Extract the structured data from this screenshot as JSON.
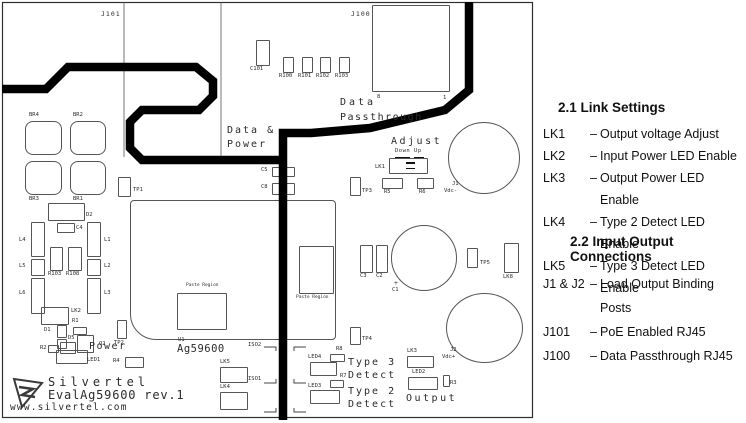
{
  "board": {
    "logo": {
      "brand": "Silvertel",
      "model": "EvalAg59600 rev.1",
      "url": "www.silvertel.com"
    },
    "components": [
      {
        "ref": "J100",
        "x": 372,
        "y": 5,
        "w": 78,
        "h": 87
      },
      {
        "ref": "C101",
        "label": "C101",
        "x": 256,
        "y": 40,
        "w": 14,
        "h": 26,
        "lx": 250,
        "ly": 67
      },
      {
        "ref": "R100",
        "label": "R100",
        "x": 283,
        "y": 57,
        "w": 11,
        "h": 16,
        "lx": 279,
        "ly": 74
      },
      {
        "ref": "R101",
        "label": "R101",
        "x": 302,
        "y": 57,
        "w": 11,
        "h": 16,
        "lx": 298,
        "ly": 74
      },
      {
        "ref": "R102",
        "label": "R102",
        "x": 320,
        "y": 57,
        "w": 11,
        "h": 16,
        "lx": 316,
        "ly": 74
      },
      {
        "ref": "R103A",
        "label": "R103",
        "x": 339,
        "y": 57,
        "w": 11,
        "h": 16,
        "lx": 335,
        "ly": 74
      },
      {
        "ref": "BR4",
        "label": "BR4",
        "x": 25,
        "y": 121,
        "w": 37,
        "h": 34,
        "lx": 29,
        "ly": 113,
        "shape": "br"
      },
      {
        "ref": "BR2",
        "label": "BR2",
        "x": 70,
        "y": 121,
        "w": 36,
        "h": 34,
        "lx": 73,
        "ly": 113,
        "shape": "br"
      },
      {
        "ref": "BR3",
        "label": "BR3",
        "x": 25,
        "y": 161,
        "w": 37,
        "h": 34,
        "lx": 29,
        "ly": 197,
        "shape": "br"
      },
      {
        "ref": "BR1",
        "label": "BR1",
        "x": 70,
        "y": 161,
        "w": 36,
        "h": 34,
        "lx": 73,
        "ly": 197,
        "shape": "br"
      },
      {
        "ref": "TP1",
        "label": "TP1",
        "x": 118,
        "y": 177,
        "w": 13,
        "h": 20,
        "lx": 133,
        "ly": 188
      },
      {
        "ref": "D2",
        "label": "D2",
        "x": 48,
        "y": 203,
        "w": 37,
        "h": 18,
        "lx": 86,
        "ly": 213
      },
      {
        "ref": "C4",
        "label": "C4",
        "x": 57,
        "y": 223,
        "w": 18,
        "h": 10,
        "lx": 76,
        "ly": 226
      },
      {
        "ref": "L4",
        "label": "L4",
        "x": 31,
        "y": 222,
        "w": 14,
        "h": 35,
        "lx": 19,
        "ly": 238
      },
      {
        "ref": "L5",
        "label": "L5",
        "x": 31,
        "y": 259,
        "w": 14,
        "h": 17,
        "lx": 19,
        "ly": 264
      },
      {
        "ref": "L6",
        "label": "L6",
        "x": 31,
        "y": 278,
        "w": 14,
        "h": 36,
        "lx": 19,
        "ly": 291
      },
      {
        "ref": "L1",
        "label": "L1",
        "x": 87,
        "y": 222,
        "w": 14,
        "h": 35,
        "lx": 104,
        "ly": 238
      },
      {
        "ref": "L2",
        "label": "L2",
        "x": 87,
        "y": 259,
        "w": 14,
        "h": 17,
        "lx": 104,
        "ly": 264
      },
      {
        "ref": "L3",
        "label": "L3",
        "x": 87,
        "y": 278,
        "w": 14,
        "h": 36,
        "lx": 104,
        "ly": 291
      },
      {
        "ref": "R103B",
        "label": "R103",
        "x": 50,
        "y": 247,
        "w": 13,
        "h": 24,
        "lx": 48,
        "ly": 272
      },
      {
        "ref": "R108",
        "label": "R108",
        "x": 68,
        "y": 247,
        "w": 14,
        "h": 24,
        "lx": 66,
        "ly": 272
      },
      {
        "ref": "LK2",
        "label": "LK2",
        "x": 41,
        "y": 307,
        "w": 28,
        "h": 18,
        "lx": 71,
        "ly": 309
      },
      {
        "ref": "R1",
        "label": "R1",
        "x": 73,
        "y": 327,
        "w": 14,
        "h": 8,
        "lx": 72,
        "ly": 319
      },
      {
        "ref": "D1",
        "label": "D1",
        "x": 57,
        "y": 325,
        "w": 10,
        "h": 13,
        "lx": 44,
        "ly": 328
      },
      {
        "ref": "D5",
        "label": "D5",
        "x": 57,
        "y": 339,
        "w": 10,
        "h": 10,
        "lx": 68,
        "ly": 336
      },
      {
        "ref": "R2",
        "label": "R2",
        "x": 48,
        "y": 345,
        "w": 11,
        "h": 8,
        "lx": 40,
        "ly": 346
      },
      {
        "ref": "Q1",
        "x": 60,
        "y": 342,
        "w": 16,
        "h": 12
      },
      {
        "ref": "Q2",
        "label": "Q2",
        "x": 77,
        "y": 335,
        "w": 17,
        "h": 18,
        "lx": 99,
        "ly": 342
      },
      {
        "ref": "LED1",
        "label": "LED1",
        "x": 56,
        "y": 350,
        "w": 32,
        "h": 14,
        "lx": 87,
        "ly": 358
      },
      {
        "ref": "R4",
        "label": "R4",
        "x": 125,
        "y": 357,
        "w": 19,
        "h": 11,
        "lx": 113,
        "ly": 359
      },
      {
        "ref": "TP2",
        "label": "TP2",
        "x": 117,
        "y": 320,
        "w": 10,
        "h": 19,
        "lx": 114,
        "ly": 341
      },
      {
        "ref": "U1",
        "x": 130,
        "y": 200,
        "w": 206,
        "h": 140,
        "shape": "ic"
      },
      {
        "ref": "PASTE1",
        "x": 177,
        "y": 293,
        "w": 50,
        "h": 37
      },
      {
        "ref": "PASTE2",
        "x": 299,
        "y": 246,
        "w": 35,
        "h": 48
      },
      {
        "ref": "C5",
        "label": "C5",
        "x": 272,
        "y": 167,
        "w": 23,
        "h": 10,
        "lx": 261,
        "ly": 168
      },
      {
        "ref": "C8",
        "label": "C8",
        "x": 272,
        "y": 183,
        "w": 23,
        "h": 12,
        "lx": 261,
        "ly": 185
      },
      {
        "ref": "TP3",
        "label": "TP3",
        "x": 350,
        "y": 177,
        "w": 11,
        "h": 19,
        "lx": 362,
        "ly": 189
      },
      {
        "ref": "LK1",
        "label": "LK1",
        "x": 389,
        "y": 158,
        "w": 39,
        "h": 16,
        "lx": 375,
        "ly": 165
      },
      {
        "ref": "R5",
        "label": "R5",
        "x": 382,
        "y": 178,
        "w": 21,
        "h": 11,
        "lx": 384,
        "ly": 190
      },
      {
        "ref": "R6",
        "label": "R6",
        "x": 417,
        "y": 178,
        "w": 17,
        "h": 11,
        "lx": 419,
        "ly": 190
      },
      {
        "ref": "J1",
        "x": 448,
        "y": 122,
        "w": 72,
        "h": 72,
        "shape": "circle"
      },
      {
        "ref": "C3",
        "label": "C3",
        "x": 360,
        "y": 245,
        "w": 13,
        "h": 28,
        "lx": 360,
        "ly": 274
      },
      {
        "ref": "C2",
        "label": "C2",
        "x": 376,
        "y": 245,
        "w": 12,
        "h": 28,
        "lx": 376,
        "ly": 274
      },
      {
        "ref": "C1",
        "x": 391,
        "y": 225,
        "w": 66,
        "h": 66,
        "shape": "circle"
      },
      {
        "ref": "TP5",
        "label": "TP5",
        "x": 467,
        "y": 248,
        "w": 11,
        "h": 20,
        "lx": 480,
        "ly": 261
      },
      {
        "ref": "LK8",
        "label": "LK8",
        "x": 504,
        "y": 243,
        "w": 15,
        "h": 30,
        "lx": 503,
        "ly": 275
      },
      {
        "ref": "TP4",
        "label": "TP4",
        "x": 350,
        "y": 327,
        "w": 11,
        "h": 18,
        "lx": 362,
        "ly": 337
      },
      {
        "ref": "R8",
        "label": "R8",
        "x": 330,
        "y": 354,
        "w": 15,
        "h": 8,
        "lx": 336,
        "ly": 347
      },
      {
        "ref": "LED4",
        "label": "LED4",
        "x": 310,
        "y": 362,
        "w": 27,
        "h": 14,
        "lx": 308,
        "ly": 355
      },
      {
        "ref": "R7",
        "label": "R7",
        "x": 330,
        "y": 380,
        "w": 14,
        "h": 8,
        "lx": 340,
        "ly": 374
      },
      {
        "ref": "LED3",
        "label": "LED3",
        "x": 310,
        "y": 390,
        "w": 30,
        "h": 14,
        "lx": 308,
        "ly": 384
      },
      {
        "ref": "LK3",
        "label": "LK3",
        "x": 407,
        "y": 356,
        "w": 27,
        "h": 12,
        "lx": 407,
        "ly": 349
      },
      {
        "ref": "LED2",
        "label": "LED2",
        "x": 408,
        "y": 377,
        "w": 30,
        "h": 13,
        "lx": 412,
        "ly": 370
      },
      {
        "ref": "R3",
        "label": "R3",
        "x": 443,
        "y": 375,
        "w": 7,
        "h": 12,
        "lx": 450,
        "ly": 381
      },
      {
        "ref": "J2",
        "x": 446,
        "y": 293,
        "w": 77,
        "h": 70,
        "shape": "circle"
      },
      {
        "ref": "LK5",
        "label": "LK5",
        "x": 220,
        "y": 367,
        "w": 28,
        "h": 16,
        "lx": 220,
        "ly": 360
      },
      {
        "ref": "LK4",
        "label": "LK4",
        "x": 220,
        "y": 392,
        "w": 28,
        "h": 18,
        "lx": 220,
        "ly": 385
      }
    ],
    "texts": [
      {
        "id": "j101-label",
        "t": "J101",
        "x": 101,
        "y": 11,
        "s": 6.5,
        "ls": 1
      },
      {
        "id": "j100-label",
        "t": "J100",
        "x": 351,
        "y": 11,
        "s": 6.5,
        "ls": 1
      },
      {
        "id": "data-passthrough-line1",
        "t": "Data",
        "x": 340,
        "y": 98,
        "s": 10,
        "ls": 3
      },
      {
        "id": "pin-8",
        "t": "8",
        "x": 377,
        "y": 95,
        "s": 5.5,
        "ls": 0
      },
      {
        "id": "pin-1",
        "t": "1",
        "x": 443,
        "y": 96,
        "s": 5.5,
        "ls": 0
      },
      {
        "id": "data-passthrough-line2",
        "t": "Passthrough",
        "x": 340,
        "y": 113,
        "s": 10,
        "ls": 1.5
      },
      {
        "id": "data-power-line1",
        "t": "Data &",
        "x": 227,
        "y": 126,
        "s": 10,
        "ls": 2
      },
      {
        "id": "data-power-line2",
        "t": "Power",
        "x": 227,
        "y": 140,
        "s": 10,
        "ls": 2
      },
      {
        "id": "adjust-label",
        "t": "Adjust",
        "x": 391,
        "y": 137,
        "s": 10,
        "ls": 2.5
      },
      {
        "id": "down-up-label",
        "t": "Down Up",
        "x": 395,
        "y": 149,
        "s": 5.5,
        "ls": 0.5
      },
      {
        "id": "power-label",
        "t": "Power",
        "x": 89,
        "y": 342,
        "s": 10,
        "ls": 1.5
      },
      {
        "id": "type3-line1",
        "t": "Type 3",
        "x": 348,
        "y": 358,
        "s": 10,
        "ls": 2
      },
      {
        "id": "type3-line2",
        "t": "Detect",
        "x": 348,
        "y": 371,
        "s": 10,
        "ls": 2
      },
      {
        "id": "type2-line1",
        "t": "Type 2",
        "x": 348,
        "y": 387,
        "s": 10,
        "ls": 2
      },
      {
        "id": "type2-line2",
        "t": "Detect",
        "x": 348,
        "y": 400,
        "s": 10,
        "ls": 2
      },
      {
        "id": "output-label",
        "t": "Output",
        "x": 406,
        "y": 394,
        "s": 10,
        "ls": 2.5
      },
      {
        "id": "u1-ref",
        "t": "U1",
        "x": 178,
        "y": 338,
        "s": 5.5,
        "ls": 0
      },
      {
        "id": "u1-part",
        "t": "Ag59600",
        "x": 177,
        "y": 344,
        "s": 10.5,
        "ls": 0.5
      },
      {
        "id": "iso2-label",
        "t": "ISO2",
        "x": 248,
        "y": 343,
        "s": 5.5,
        "ls": 0
      },
      {
        "id": "iso1-label",
        "t": "ISO1",
        "x": 248,
        "y": 377,
        "s": 5.5,
        "ls": 0
      },
      {
        "id": "paste-region-1",
        "t": "Paste Region",
        "x": 186,
        "y": 284,
        "s": 4.5,
        "ls": 0
      },
      {
        "id": "paste-region-2",
        "t": "Paste Region",
        "x": 296,
        "y": 296,
        "s": 4.5,
        "ls": 0
      },
      {
        "id": "j1-ref",
        "t": "J1",
        "x": 452,
        "y": 182,
        "s": 5.5,
        "ls": 0
      },
      {
        "id": "j1-polarity",
        "t": "Vdc-",
        "x": 444,
        "y": 189,
        "s": 5.5,
        "ls": 0
      },
      {
        "id": "j2-ref",
        "t": "J2",
        "x": 450,
        "y": 348,
        "s": 5.5,
        "ls": 0
      },
      {
        "id": "j2-polarity",
        "t": "Vdc+",
        "x": 442,
        "y": 355,
        "s": 5.5,
        "ls": 0
      },
      {
        "id": "c1-plus",
        "t": "+",
        "x": 394,
        "y": 280,
        "s": 6.5,
        "ls": 0
      },
      {
        "id": "c1-ref",
        "t": "C1",
        "x": 392,
        "y": 288,
        "s": 5.5,
        "ls": 0
      }
    ],
    "marks": [
      {
        "id": "lk1-jumper-dash-1",
        "x": 406,
        "y": 162,
        "w": 9,
        "h": 1.8
      },
      {
        "id": "lk1-jumper-dash-2",
        "x": 406,
        "y": 167.5,
        "w": 9,
        "h": 1.8
      },
      {
        "id": "down-underline",
        "x": 395,
        "y": 156.5,
        "w": 15,
        "h": 0.9
      },
      {
        "id": "up-underline",
        "x": 414,
        "y": 156.5,
        "w": 10,
        "h": 0.9
      }
    ]
  },
  "legend": {
    "separator": "–",
    "sections": [
      {
        "title": "2.1 Link Settings",
        "rows": [
          {
            "label": "LK1",
            "desc": "Output voltage Adjust"
          },
          {
            "label": "LK2",
            "desc": "Input Power LED Enable"
          },
          {
            "label": "LK3",
            "desc": "Output Power LED Enable"
          },
          {
            "label": "LK4",
            "desc": "Type 2 Detect LED Enable"
          },
          {
            "label": "LK5",
            "desc": "Type 3 Detect LED Enable"
          }
        ]
      },
      {
        "title": "2.2 Input Output Connections",
        "rows": [
          {
            "label": "J1 & J2",
            "desc": "Load Output Binding Posts"
          },
          {
            "label": "J101",
            "desc": "PoE Enabled RJ45"
          },
          {
            "label": "J100",
            "desc": "Data Passthrough RJ45"
          }
        ]
      }
    ]
  }
}
